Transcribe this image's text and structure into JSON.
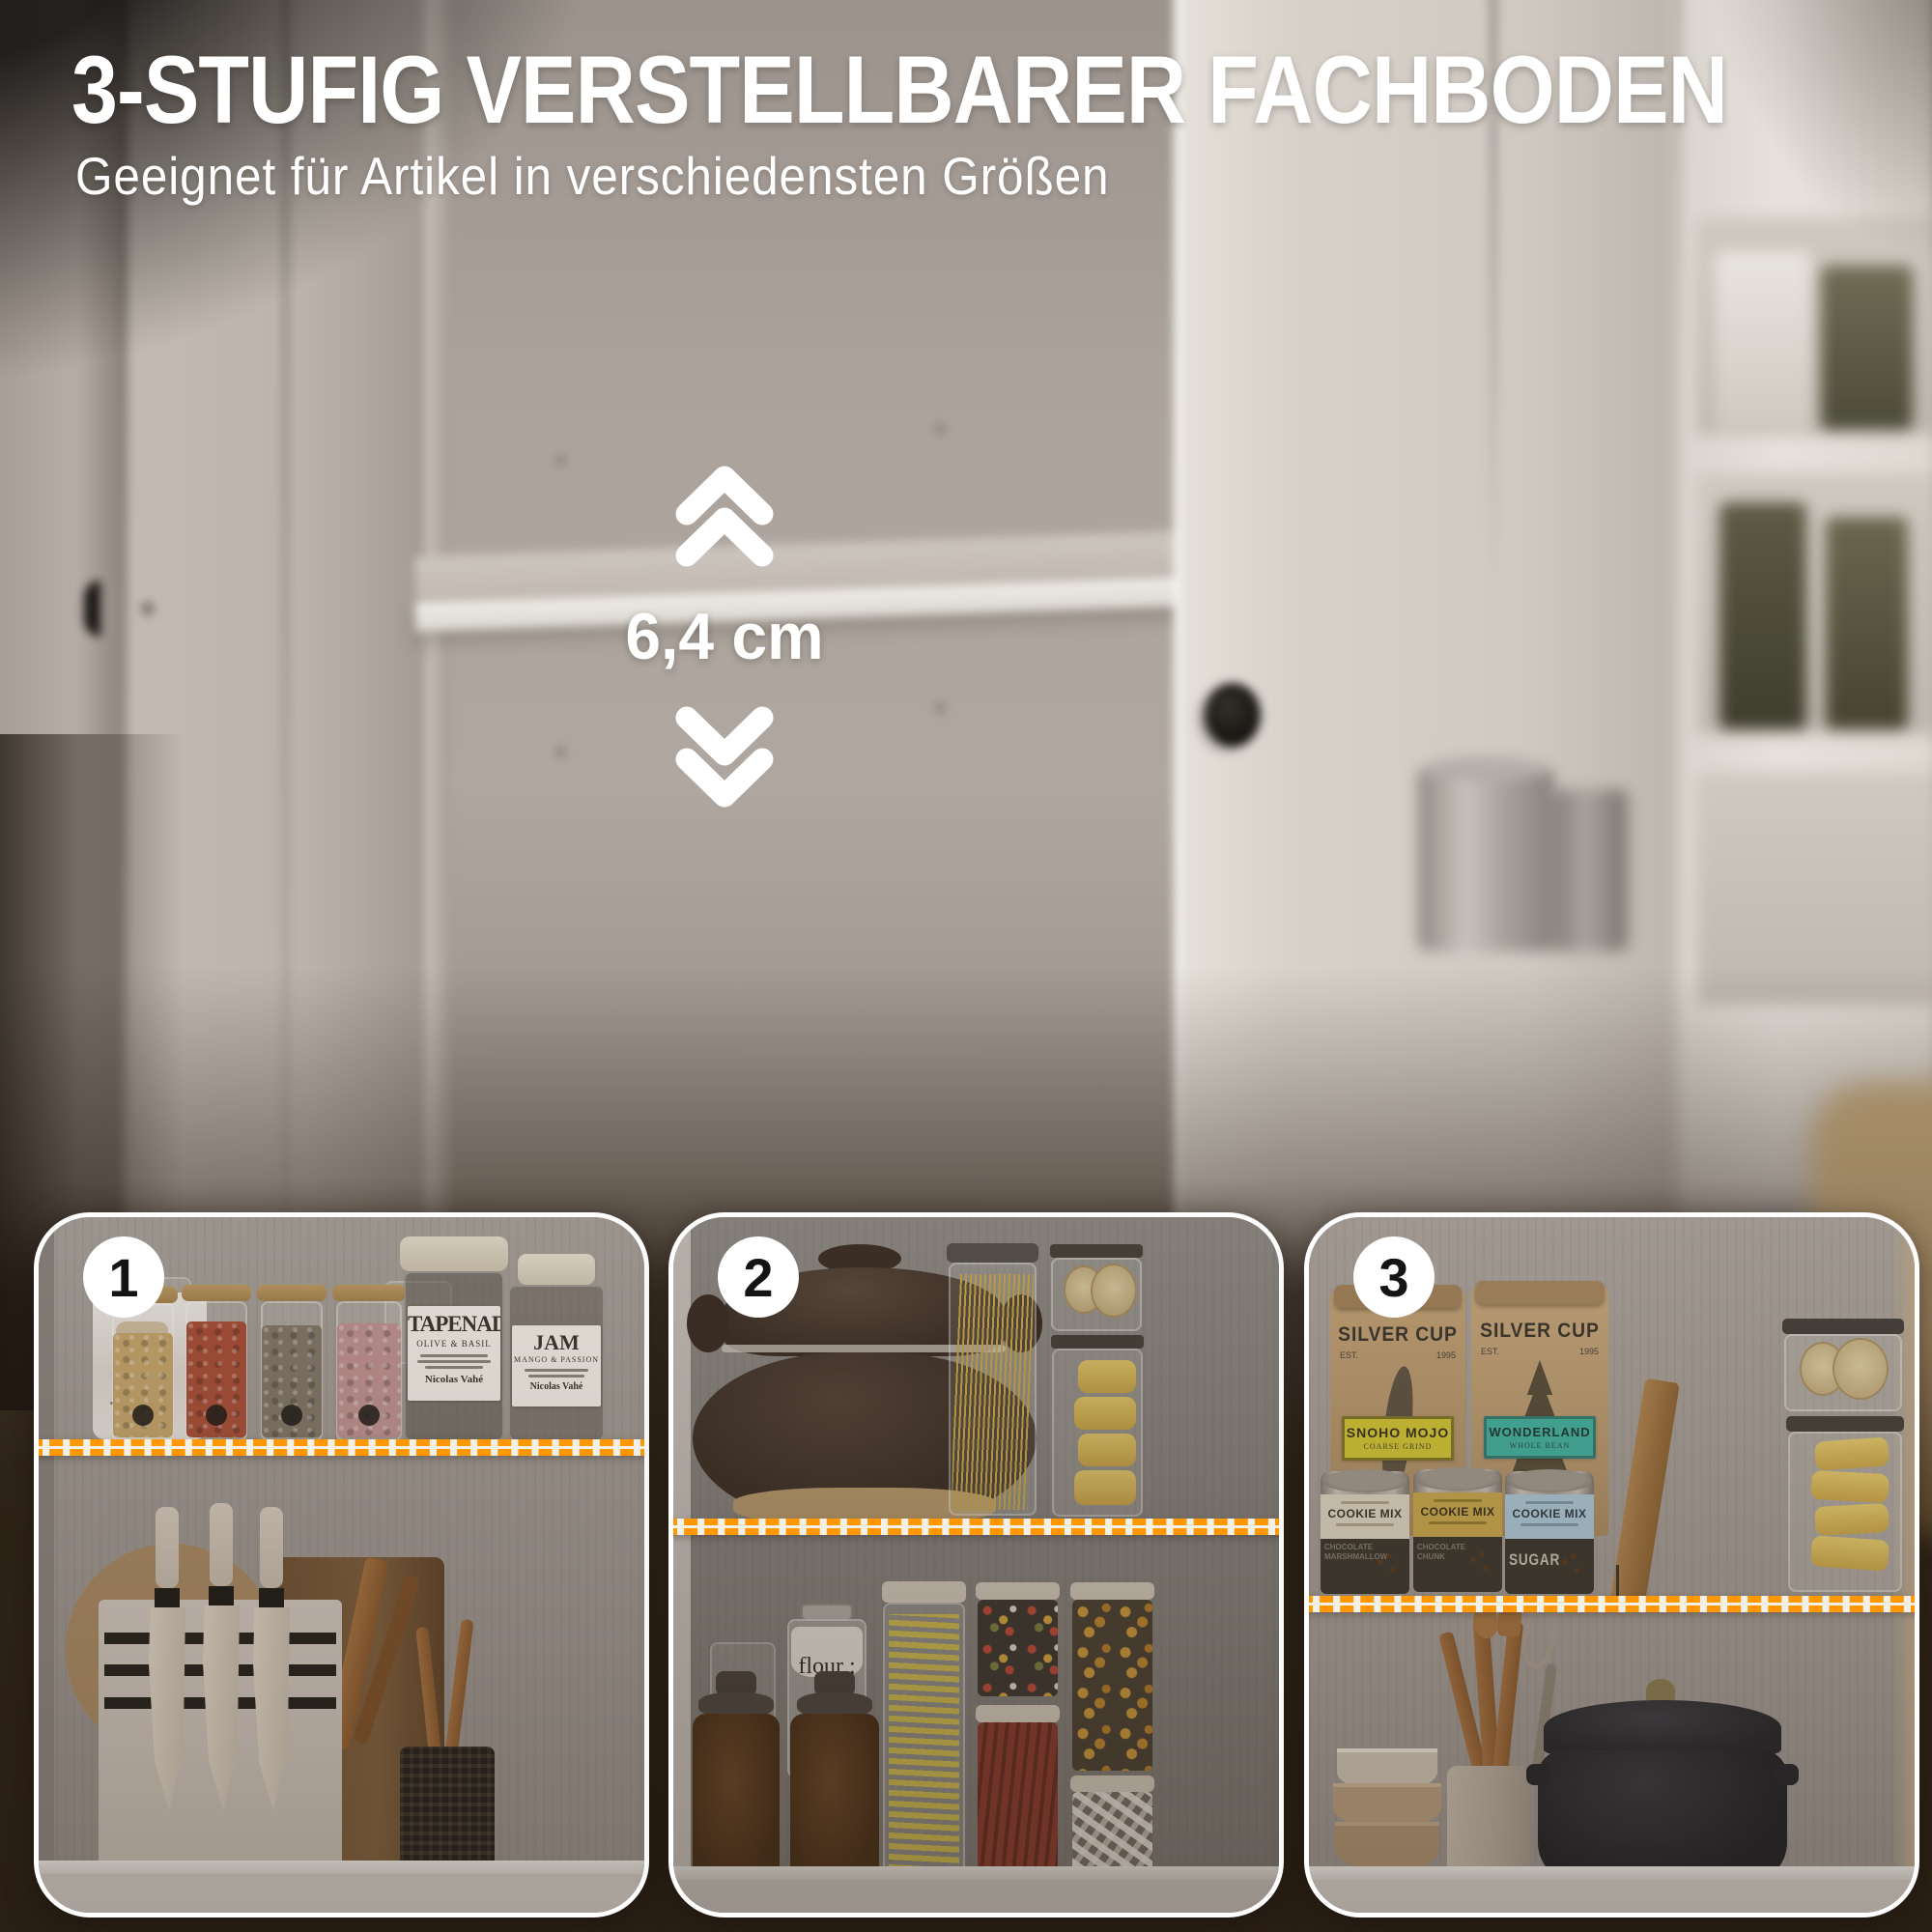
{
  "header": {
    "title": "3-STUFIG VERSTELLBARER FACHBODEN",
    "subtitle": "Geeignet für Artikel in verschiedensten Größen"
  },
  "measurement": {
    "value": "6,4 cm",
    "up_icon": "double-chevron-up",
    "down_icon": "double-chevron-down"
  },
  "colors": {
    "highlight_orange": "#FF9800",
    "shelf_white": "#F3F0EA",
    "vignette_brown": "#2F2418",
    "text_white": "#FFFFFF"
  },
  "panels": [
    {
      "number": "1"
    },
    {
      "number": "2"
    },
    {
      "number": "3"
    }
  ],
  "products": {
    "tapenade": {
      "name": "TAPENADE",
      "variety": "OLIVE & BASIL",
      "brand": "Nicolas Vahé"
    },
    "jam": {
      "name": "JAM",
      "variety": "MANGO & PASSION",
      "brand": "Nicolas Vahé"
    },
    "flour": {
      "name": "flour ;"
    },
    "coffee_bag_1": {
      "brand": "SILVER CUP",
      "est": "EST.",
      "year": "1995",
      "label": "SNOHO MOJO",
      "sub_label": "COARSE GRIND"
    },
    "coffee_bag_2": {
      "brand": "SILVER CUP",
      "est": "EST.",
      "year": "1995",
      "label": "WONDERLAND",
      "sub_label": "WHOLE BEAN"
    },
    "tin_1": {
      "label": "COOKIE MIX",
      "ghost": "CHOCOLATE MARSHMALLOW"
    },
    "tin_2": {
      "label": "COOKIE MIX",
      "ghost": "CHOCOLATE CHUNK"
    },
    "tin_3": {
      "label": "COOKIE MIX",
      "ghost": "SUGAR"
    }
  }
}
